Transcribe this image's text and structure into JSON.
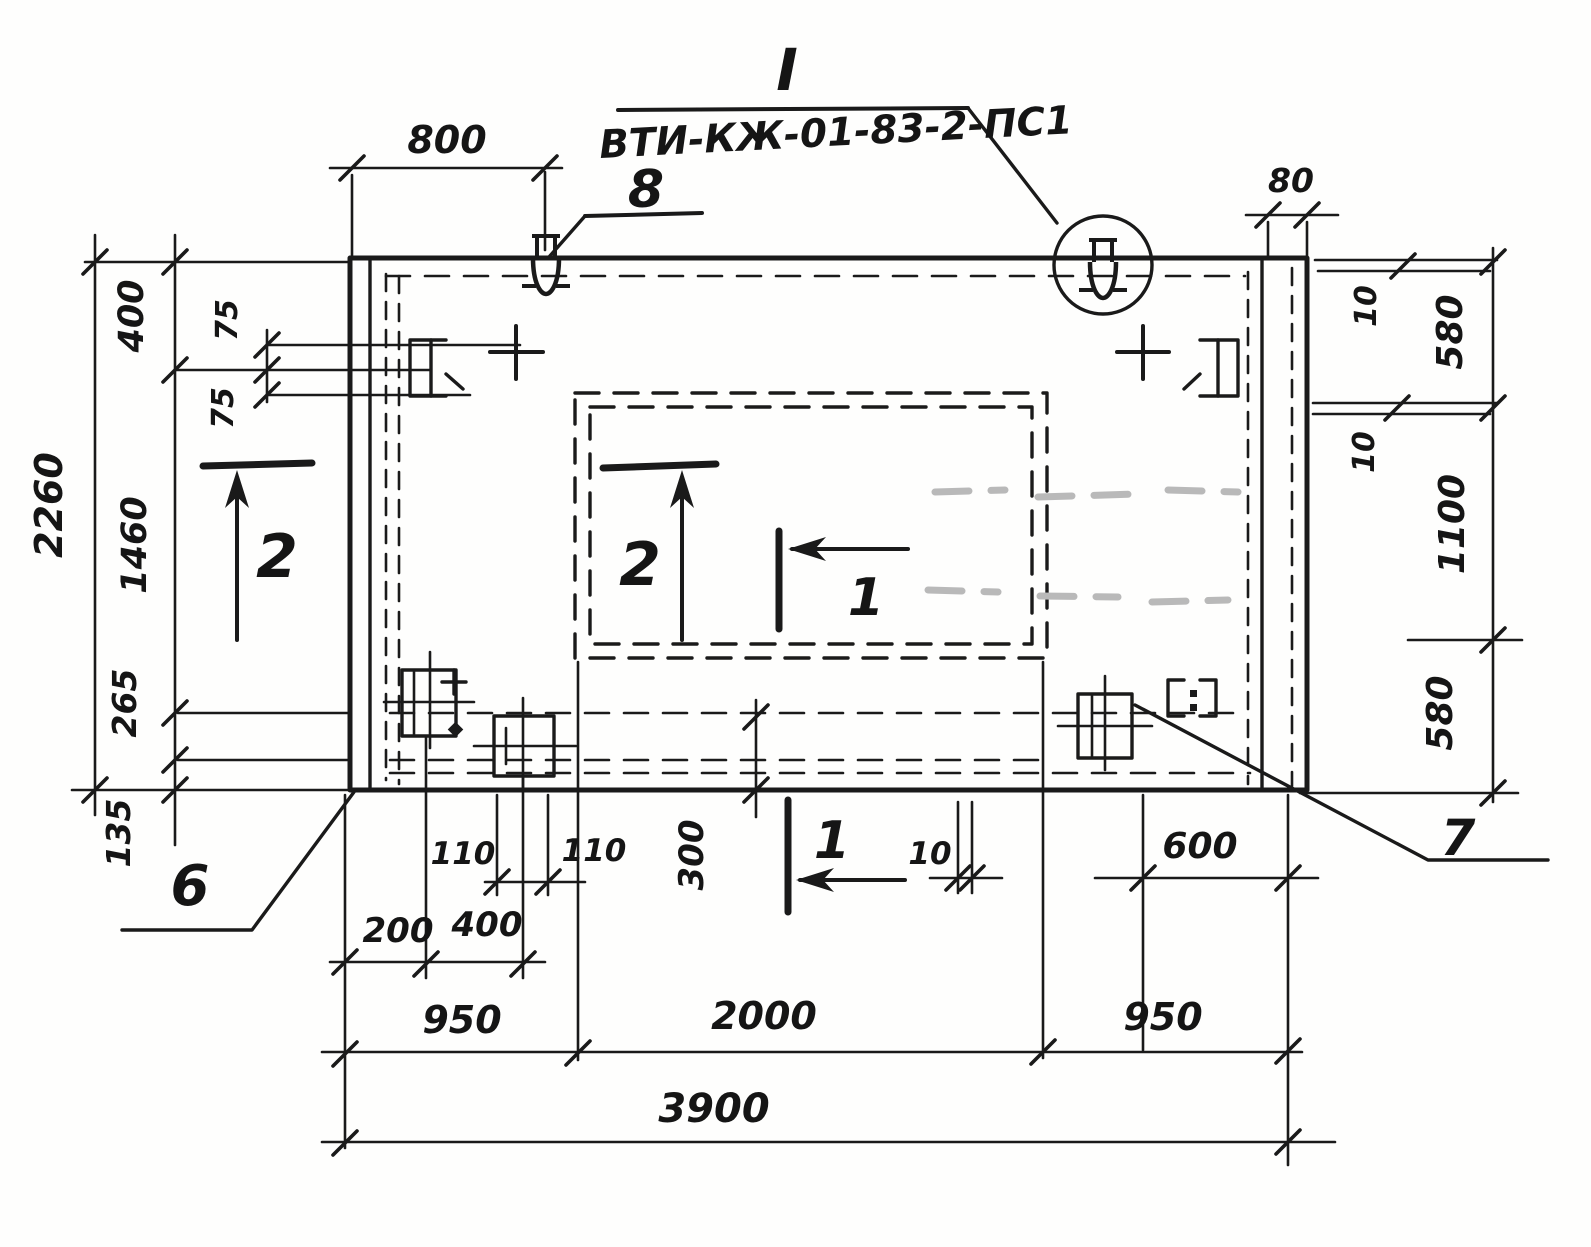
{
  "title": {
    "detail_mark": "I",
    "code": "ВТИ-КЖ-01-83-2-ПС1"
  },
  "labels": {
    "lifting_loop_item": "8",
    "corner_item": "6",
    "plate_item": "7",
    "section_1": "1",
    "section_2": "2"
  },
  "dimensions": {
    "top_offset": "800",
    "top_edge": "80",
    "left": {
      "total": "2260",
      "chain": [
        "400",
        "1460",
        "265",
        "135"
      ],
      "sub": [
        "75",
        "75"
      ]
    },
    "right": {
      "gap_top": "10",
      "top": "580",
      "gap_mid": "10",
      "middle": "1100",
      "bottom": "580"
    },
    "bottom": {
      "plate_pitch": [
        "110",
        "110"
      ],
      "offsets": [
        "200",
        "400"
      ],
      "edge_distance": "300",
      "gap": "10",
      "lap": "600",
      "chain": [
        "950",
        "2000",
        "950"
      ],
      "total": "3900"
    }
  }
}
